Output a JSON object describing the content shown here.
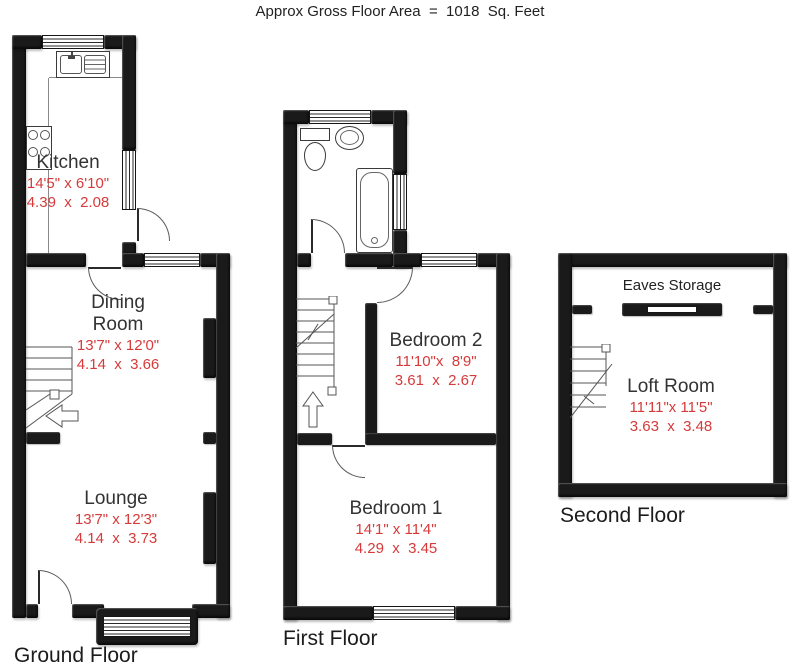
{
  "title": "Approx Gross Floor Area  =  1018  Sq. Feet",
  "floors": {
    "ground": {
      "label": "Ground Floor",
      "rooms": {
        "kitchen": {
          "name": "Kitchen",
          "imperial": "14'5\" x 6'10\"",
          "metric": "4.39  x  2.08"
        },
        "dining": {
          "name": "Dining Room",
          "imperial": "13'7\" x 12'0\"",
          "metric": "4.14  x  3.66"
        },
        "lounge": {
          "name": "Lounge",
          "imperial": "13'7\" x 12'3\"",
          "metric": "4.14  x  3.73"
        }
      }
    },
    "first": {
      "label": "First Floor",
      "rooms": {
        "bedroom2": {
          "name": "Bedroom 2",
          "imperial": "11'10\"x  8'9\"",
          "metric": "3.61  x  2.67"
        },
        "bedroom1": {
          "name": "Bedroom 1",
          "imperial": "14'1\" x 11'4\"",
          "metric": "4.29  x  3.45"
        }
      }
    },
    "second": {
      "label": "Second Floor",
      "eaves_label": "Eaves Storage",
      "rooms": {
        "loft": {
          "name": "Loft Room",
          "imperial": "11'11\"x 11'5\"",
          "metric": "3.63  x  3.48"
        }
      }
    }
  },
  "colors": {
    "wall": "#1a1a1a",
    "dimension_text": "#d63a3a",
    "room_text": "#333333"
  }
}
